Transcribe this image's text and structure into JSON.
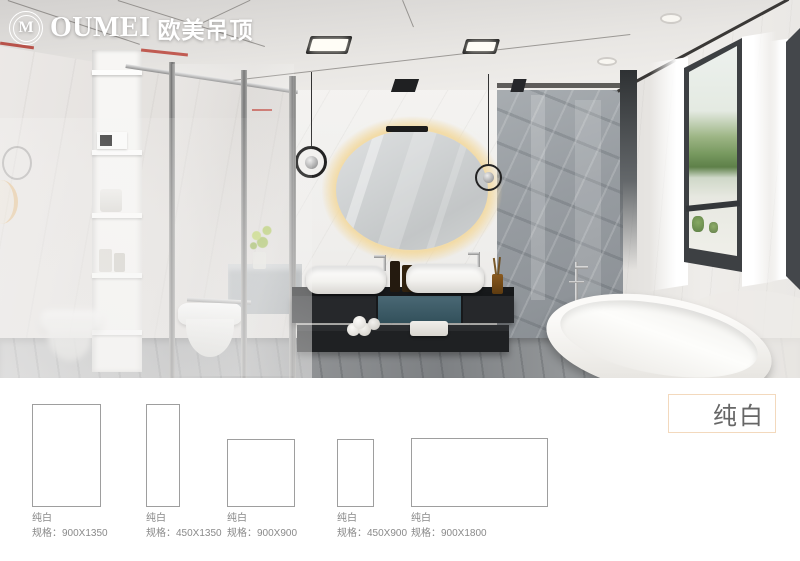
{
  "brand": {
    "symbol": "M",
    "name": "OUMEI",
    "name_cn": "欧美吊顶"
  },
  "product": {
    "title": "纯白"
  },
  "swatches": [
    {
      "name": "纯白",
      "spec": "规格：900X1350"
    },
    {
      "name": "纯白",
      "spec": "规格：450X1350"
    },
    {
      "name": "纯白",
      "spec": "规格：900X900"
    },
    {
      "name": "纯白",
      "spec": "规格：450X900"
    },
    {
      "name": "纯白",
      "spec": "规格：900X1800"
    }
  ],
  "colors": {
    "accent_border": "#f3d9bd",
    "label_text": "#8a8a8a",
    "title_text": "#666666",
    "swatch_border": "#9e9e9e",
    "vanity_teal": "#41606c",
    "mirror_glow": "#f3dda6"
  }
}
